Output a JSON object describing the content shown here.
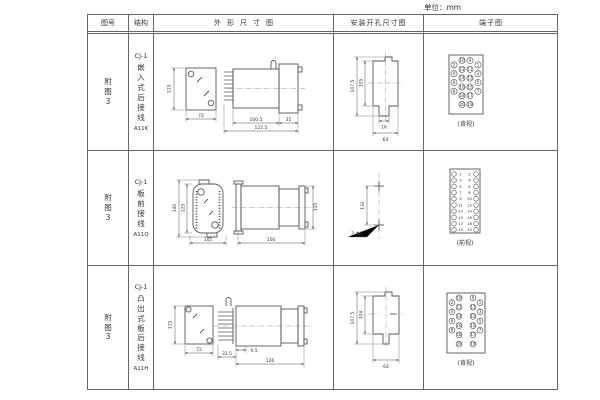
{
  "unit_label": "单位：mm",
  "header": {
    "fig_no": "图号",
    "structure": "结构",
    "outline": "外形尺寸图",
    "install": "安装开孔尺寸图",
    "terminal": "端子图"
  },
  "rows": [
    {
      "fig_no": "附\n图\n3",
      "model": "CJ-1",
      "name": "嵌\n入\n式\n后\n接\n线",
      "code": "A11K",
      "outline": {
        "height": "115",
        "width": "72",
        "body_len": "100.5",
        "total_len": "122.5",
        "flange_w": "35"
      },
      "install": {
        "outer_h": "107.5",
        "inner_h": "105",
        "slot_w": "16",
        "width": "64"
      },
      "terminal": {
        "view": "(背视)",
        "cells": [
          {
            "r": 0.5,
            "c": 0,
            "n": 2
          },
          {
            "r": 1.5,
            "c": 0,
            "n": 4
          },
          {
            "r": 2.5,
            "c": 0,
            "n": 6
          },
          {
            "r": 3.5,
            "c": 0,
            "n": 8
          },
          {
            "r": 0,
            "c": 1,
            "n": 10
          },
          {
            "r": 1,
            "c": 1,
            "n": 12
          },
          {
            "r": 2,
            "c": 1,
            "n": 14
          },
          {
            "r": 3,
            "c": 1,
            "n": 16
          },
          {
            "r": 4,
            "c": 1,
            "n": 18
          },
          {
            "r": 5,
            "c": 1,
            "n": 20
          },
          {
            "r": 0,
            "c": 2,
            "n": 9
          },
          {
            "r": 1,
            "c": 2,
            "n": 11
          },
          {
            "r": 2,
            "c": 2,
            "n": 13
          },
          {
            "r": 3,
            "c": 2,
            "n": 15
          },
          {
            "r": 4,
            "c": 2,
            "n": 17
          },
          {
            "r": 5,
            "c": 2,
            "n": 19
          },
          {
            "r": 0.5,
            "c": 3,
            "n": 1
          },
          {
            "r": 1.5,
            "c": 3,
            "n": 3
          },
          {
            "r": 2.5,
            "c": 3,
            "n": 5
          },
          {
            "r": 3.5,
            "c": 3,
            "n": 7
          }
        ]
      }
    },
    {
      "fig_no": "附\n图\n3",
      "model": "CJ-1",
      "name": "板\n前\n接\n线",
      "code": "A11Q",
      "outline": {
        "outer_h": "140",
        "inner_h": "125",
        "width": "105",
        "length": "156",
        "height": "115"
      },
      "install": {
        "hole_spacing": "132",
        "holes": "2-Φ5"
      },
      "terminal": {
        "view": "(前视)",
        "cells": [
          {
            "r": 0,
            "c": 0,
            "n": 1
          },
          {
            "r": 1,
            "c": 0,
            "n": 3
          },
          {
            "r": 2,
            "c": 0,
            "n": 5
          },
          {
            "r": 3,
            "c": 0,
            "n": 7
          },
          {
            "r": 4,
            "c": 0,
            "n": 9
          },
          {
            "r": 5,
            "c": 0,
            "n": 11
          },
          {
            "r": 6,
            "c": 0,
            "n": 13
          },
          {
            "r": 7,
            "c": 0,
            "n": 15
          },
          {
            "r": 8,
            "c": 0,
            "n": 17
          },
          {
            "r": 9,
            "c": 0,
            "n": 19
          },
          {
            "r": 0,
            "c": 3,
            "n": 2
          },
          {
            "r": 1,
            "c": 3,
            "n": 4
          },
          {
            "r": 2,
            "c": 3,
            "n": 6
          },
          {
            "r": 3,
            "c": 3,
            "n": 8
          },
          {
            "r": 4,
            "c": 3,
            "n": 10
          },
          {
            "r": 5,
            "c": 3,
            "n": 12
          },
          {
            "r": 6,
            "c": 3,
            "n": 14
          },
          {
            "r": 7,
            "c": 3,
            "n": 16
          },
          {
            "r": 8,
            "c": 3,
            "n": 18
          },
          {
            "r": 9,
            "c": 3,
            "n": 20
          }
        ]
      }
    },
    {
      "fig_no": "附\n图\n3",
      "model": "CJ-1",
      "name": "凸\n出\n式\n板\n后\n接\n线",
      "code": "A11H",
      "outline": {
        "height": "115",
        "width": "72",
        "pin_len": "31.5",
        "offset": "9.5",
        "length": "126"
      },
      "install": {
        "outer_h": "107.5",
        "inner_h": "104",
        "width": "64"
      },
      "terminal": {
        "view": "(背视)",
        "cells": [
          {
            "r": 0.5,
            "c": 0,
            "n": 2
          },
          {
            "r": 1.5,
            "c": 0,
            "n": 4
          },
          {
            "r": 2.5,
            "c": 0,
            "n": 6
          },
          {
            "r": 3.5,
            "c": 0,
            "n": 8
          },
          {
            "r": 0,
            "c": 1,
            "n": 10
          },
          {
            "r": 1,
            "c": 1,
            "n": 12
          },
          {
            "r": 2,
            "c": 1,
            "n": 14
          },
          {
            "r": 3,
            "c": 1,
            "n": 16
          },
          {
            "r": 4,
            "c": 1,
            "n": 18
          },
          {
            "r": 5,
            "c": 1,
            "n": 20
          },
          {
            "r": 0,
            "c": 2,
            "n": 9
          },
          {
            "r": 1,
            "c": 2,
            "n": 11
          },
          {
            "r": 2,
            "c": 2,
            "n": 13
          },
          {
            "r": 3,
            "c": 2,
            "n": 15
          },
          {
            "r": 4,
            "c": 2,
            "n": 17
          },
          {
            "r": 5,
            "c": 2,
            "n": 19
          },
          {
            "r": 0.5,
            "c": 3,
            "n": 1
          },
          {
            "r": 1.5,
            "c": 3,
            "n": 3
          },
          {
            "r": 2.5,
            "c": 3,
            "n": 5
          },
          {
            "r": 3.5,
            "c": 3,
            "n": 7
          }
        ]
      }
    }
  ]
}
